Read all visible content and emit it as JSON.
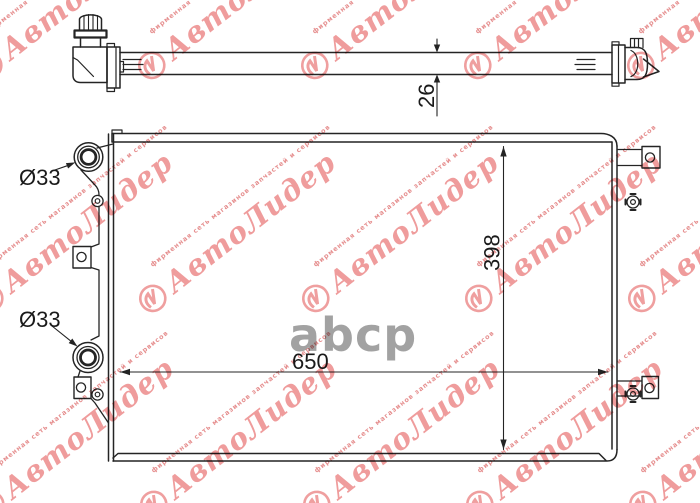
{
  "document": {
    "type": "radiator-technical-drawing"
  },
  "views": {
    "top_view": {
      "thickness_label": "26"
    },
    "front_view": {
      "width_label": "650",
      "height_label": "398",
      "upper_port_label": "Ø33",
      "lower_port_label": "Ø33"
    }
  },
  "watermark": {
    "brand": "АвтоЛидер",
    "tagline": "фирменная сеть магазинов запчастей и сервисов",
    "brand_color": "#ef9c9c",
    "center_logo_text": "abcp",
    "center_logo_color": "#9b9b9b"
  },
  "drawing": {
    "line_color": "#242424",
    "background": "#ffffff"
  }
}
